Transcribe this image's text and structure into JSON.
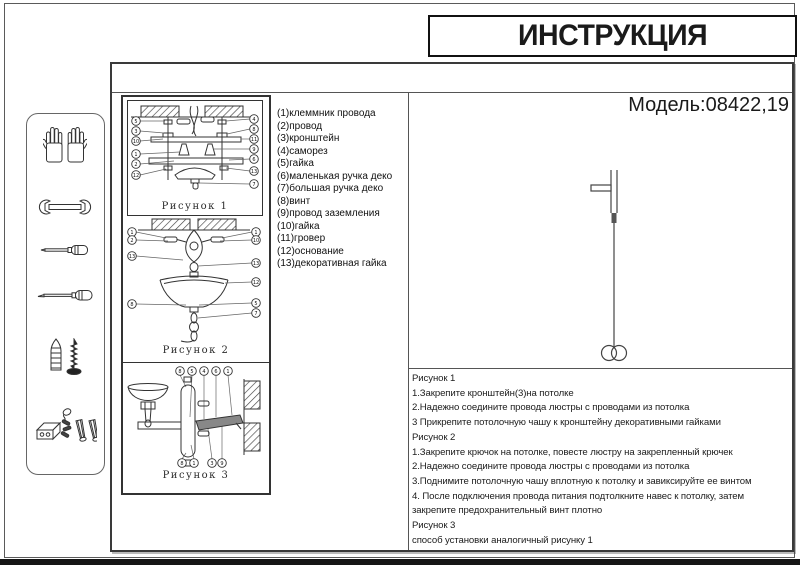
{
  "page": {
    "title": "ИНСТРУКЦИЯ",
    "model": "Модель:08422,19",
    "ink_color": "#333333"
  },
  "tools_panel": {
    "icons": [
      "work-gloves",
      "open-end-wrench",
      "screwdriver",
      "long-screwdriver",
      "wall-plug-and-screw",
      "terminal-block-and-anchors"
    ]
  },
  "parts_list": [
    "(1)клеммник провода",
    "(2)провод",
    "(3)кронштейн",
    "(4)саморез",
    "(5)гайка",
    "(6)маленькая ручка деко",
    "(7)большая ручка деко",
    "(8)винт",
    "(9)провод заземления",
    "(10)гайка",
    "(11)гровер",
    "(12)основание",
    "(13)декоративная гайка"
  ],
  "figures": [
    {
      "label": "Рисунок 1",
      "callouts_left": [
        "5",
        "3",
        "10",
        "1",
        "2",
        "12"
      ],
      "callouts_right": [
        "4",
        "8",
        "11",
        "9",
        "6",
        "13",
        "7"
      ]
    },
    {
      "label": "Рисунок 2",
      "callouts_left": [
        "1",
        "2",
        "13",
        "8"
      ],
      "callouts_right": [
        "1",
        "10",
        "13",
        "12",
        "5",
        "7"
      ]
    },
    {
      "label": "Рисунок 3",
      "callouts_top": [
        "8",
        "5",
        "4",
        "6",
        "1"
      ],
      "callouts_bottom": [
        "8",
        "1",
        "3",
        "9"
      ]
    }
  ],
  "instructions": [
    "Рисунок 1",
    "1.Закрепите кронштейн(3)на потолке",
    "2.Надежно соедините провода люстры с проводами из потолка",
    "3 Прикрепите потолочную чашу к кронштейну декоративными гайками",
    "Рисунок 2",
    "1.Закрепите крючок на потолке, повесте люстру на закрепленный крючек",
    "2.Надежно соедините провода люстры с проводами из потолка",
    "3.Поднимите потолочную чашу вплотную к потолку и завиксируйте ее винтом",
    "4. После подключения провода питания подтолкните навес к потолку, затем закрепите предохранительный винт плотно",
    "Рисунок 3",
    " способ установки аналогичный рисунку 1"
  ]
}
